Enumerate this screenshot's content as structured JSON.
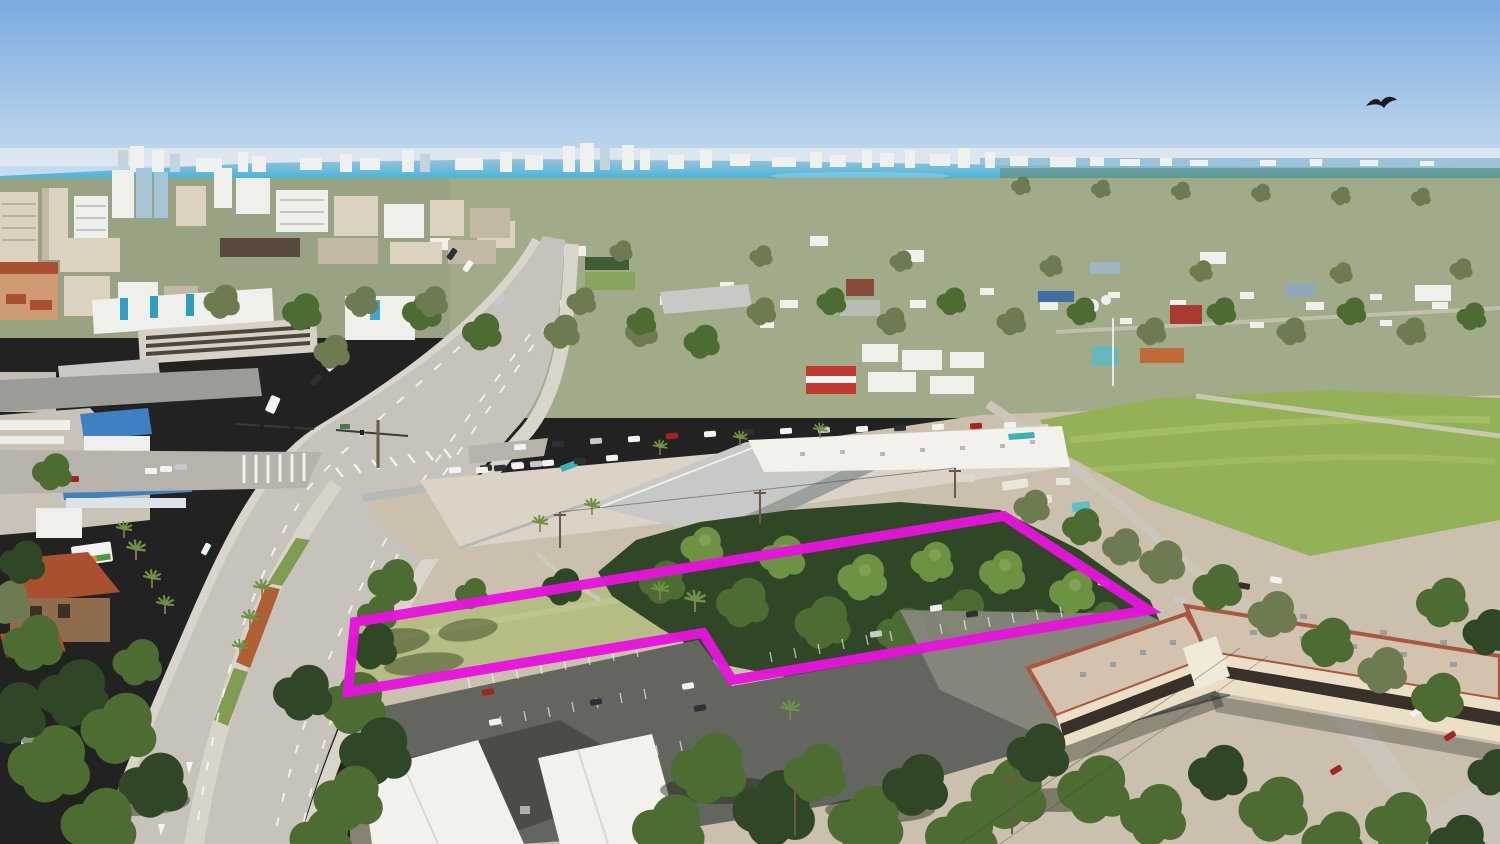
{
  "scene": {
    "type": "aerial-drone-photograph",
    "subject": "vacant wooded land parcel outlined in magenta",
    "setting": "coastal city: downtown skyline and bay on horizon, divided highway on left, shopping plaza center, condo buildings lower right",
    "highlight_shape": "flag-shaped parcel boundary with notch around parking lot"
  },
  "colors": {
    "sky_top": "#79abdf",
    "sky_horizon": "#c9dcee",
    "haze": "#dfe8ef",
    "water_bay": "#3fb5db",
    "water_far": "#9dc3d9",
    "shore_white": "#eff1ee",
    "shore_blue": "#c2d5de",
    "suburb_base": "#a2ab89",
    "suburb_left": "#99a383",
    "tree_dark": "#2f4726",
    "tree_mid": "#4c6c31",
    "tree_light": "#6d9342",
    "tree_olive": "#6d7c50",
    "tree_pale": "#87a45c",
    "lawn": "#b5bc84",
    "field": "#93b257",
    "field_light": "#a9c468",
    "road": "#c7c2ba",
    "road_shade": "#b7b2aa",
    "asphalt": "#63655f",
    "asphalt_light": "#8a887f",
    "median": "#d9d4ca",
    "median_grass": "#7f9c52",
    "brick_median": "#b05f35",
    "sidewalk": "#d9d5cb",
    "dirt": "#cbc0ad",
    "plaza_pave": "#dcd2c6",
    "roof_white": "#f2f1ec",
    "roof_gray": "#c6c9c6",
    "roof_gray_dark": "#9aa09b",
    "bld_white": "#eff0ec",
    "bld_beige": "#dbd2c0",
    "bld_beige_dark": "#c2b8a4",
    "bld_blue": "#a5c4d6",
    "bld_dark": "#584a3c",
    "garage": "#d8d1c5",
    "salmon_wall": "#cf9b74",
    "terra_roof": "#a9502e",
    "house_wall": "#8f6d4c",
    "orange_roof": "#d4782f",
    "cream_wall": "#e9dab6",
    "blue_roof": "#3f80c2",
    "teal": "#3ab3b3",
    "tarp_teal": "#5fc0c4",
    "red_bld": "#c4392f",
    "red_barn": "#a83a30",
    "pavilion": "#3e5c36",
    "condo_roof": "#d3c3ae",
    "condo_trim": "#a9573f",
    "condo_wall": "#ebe0c6",
    "window_band": "#393129",
    "marking": "#ffffff",
    "car_white": "#f2f2f1",
    "car_dark": "#2e3134",
    "car_red": "#a7231e",
    "car_silver": "#c6c9cb",
    "pole": "#6b5b45",
    "wire": "#3f3f3d",
    "flag_pole": "#e8e8e8",
    "magenta": "#e613dc",
    "bird": "#1c1c1e"
  },
  "boundary": {
    "points": "355,622 1004,516 1148,610 732,680 703,633 348,692",
    "stroke_width": 10
  },
  "bird": {
    "x": 1382,
    "y": 102
  }
}
